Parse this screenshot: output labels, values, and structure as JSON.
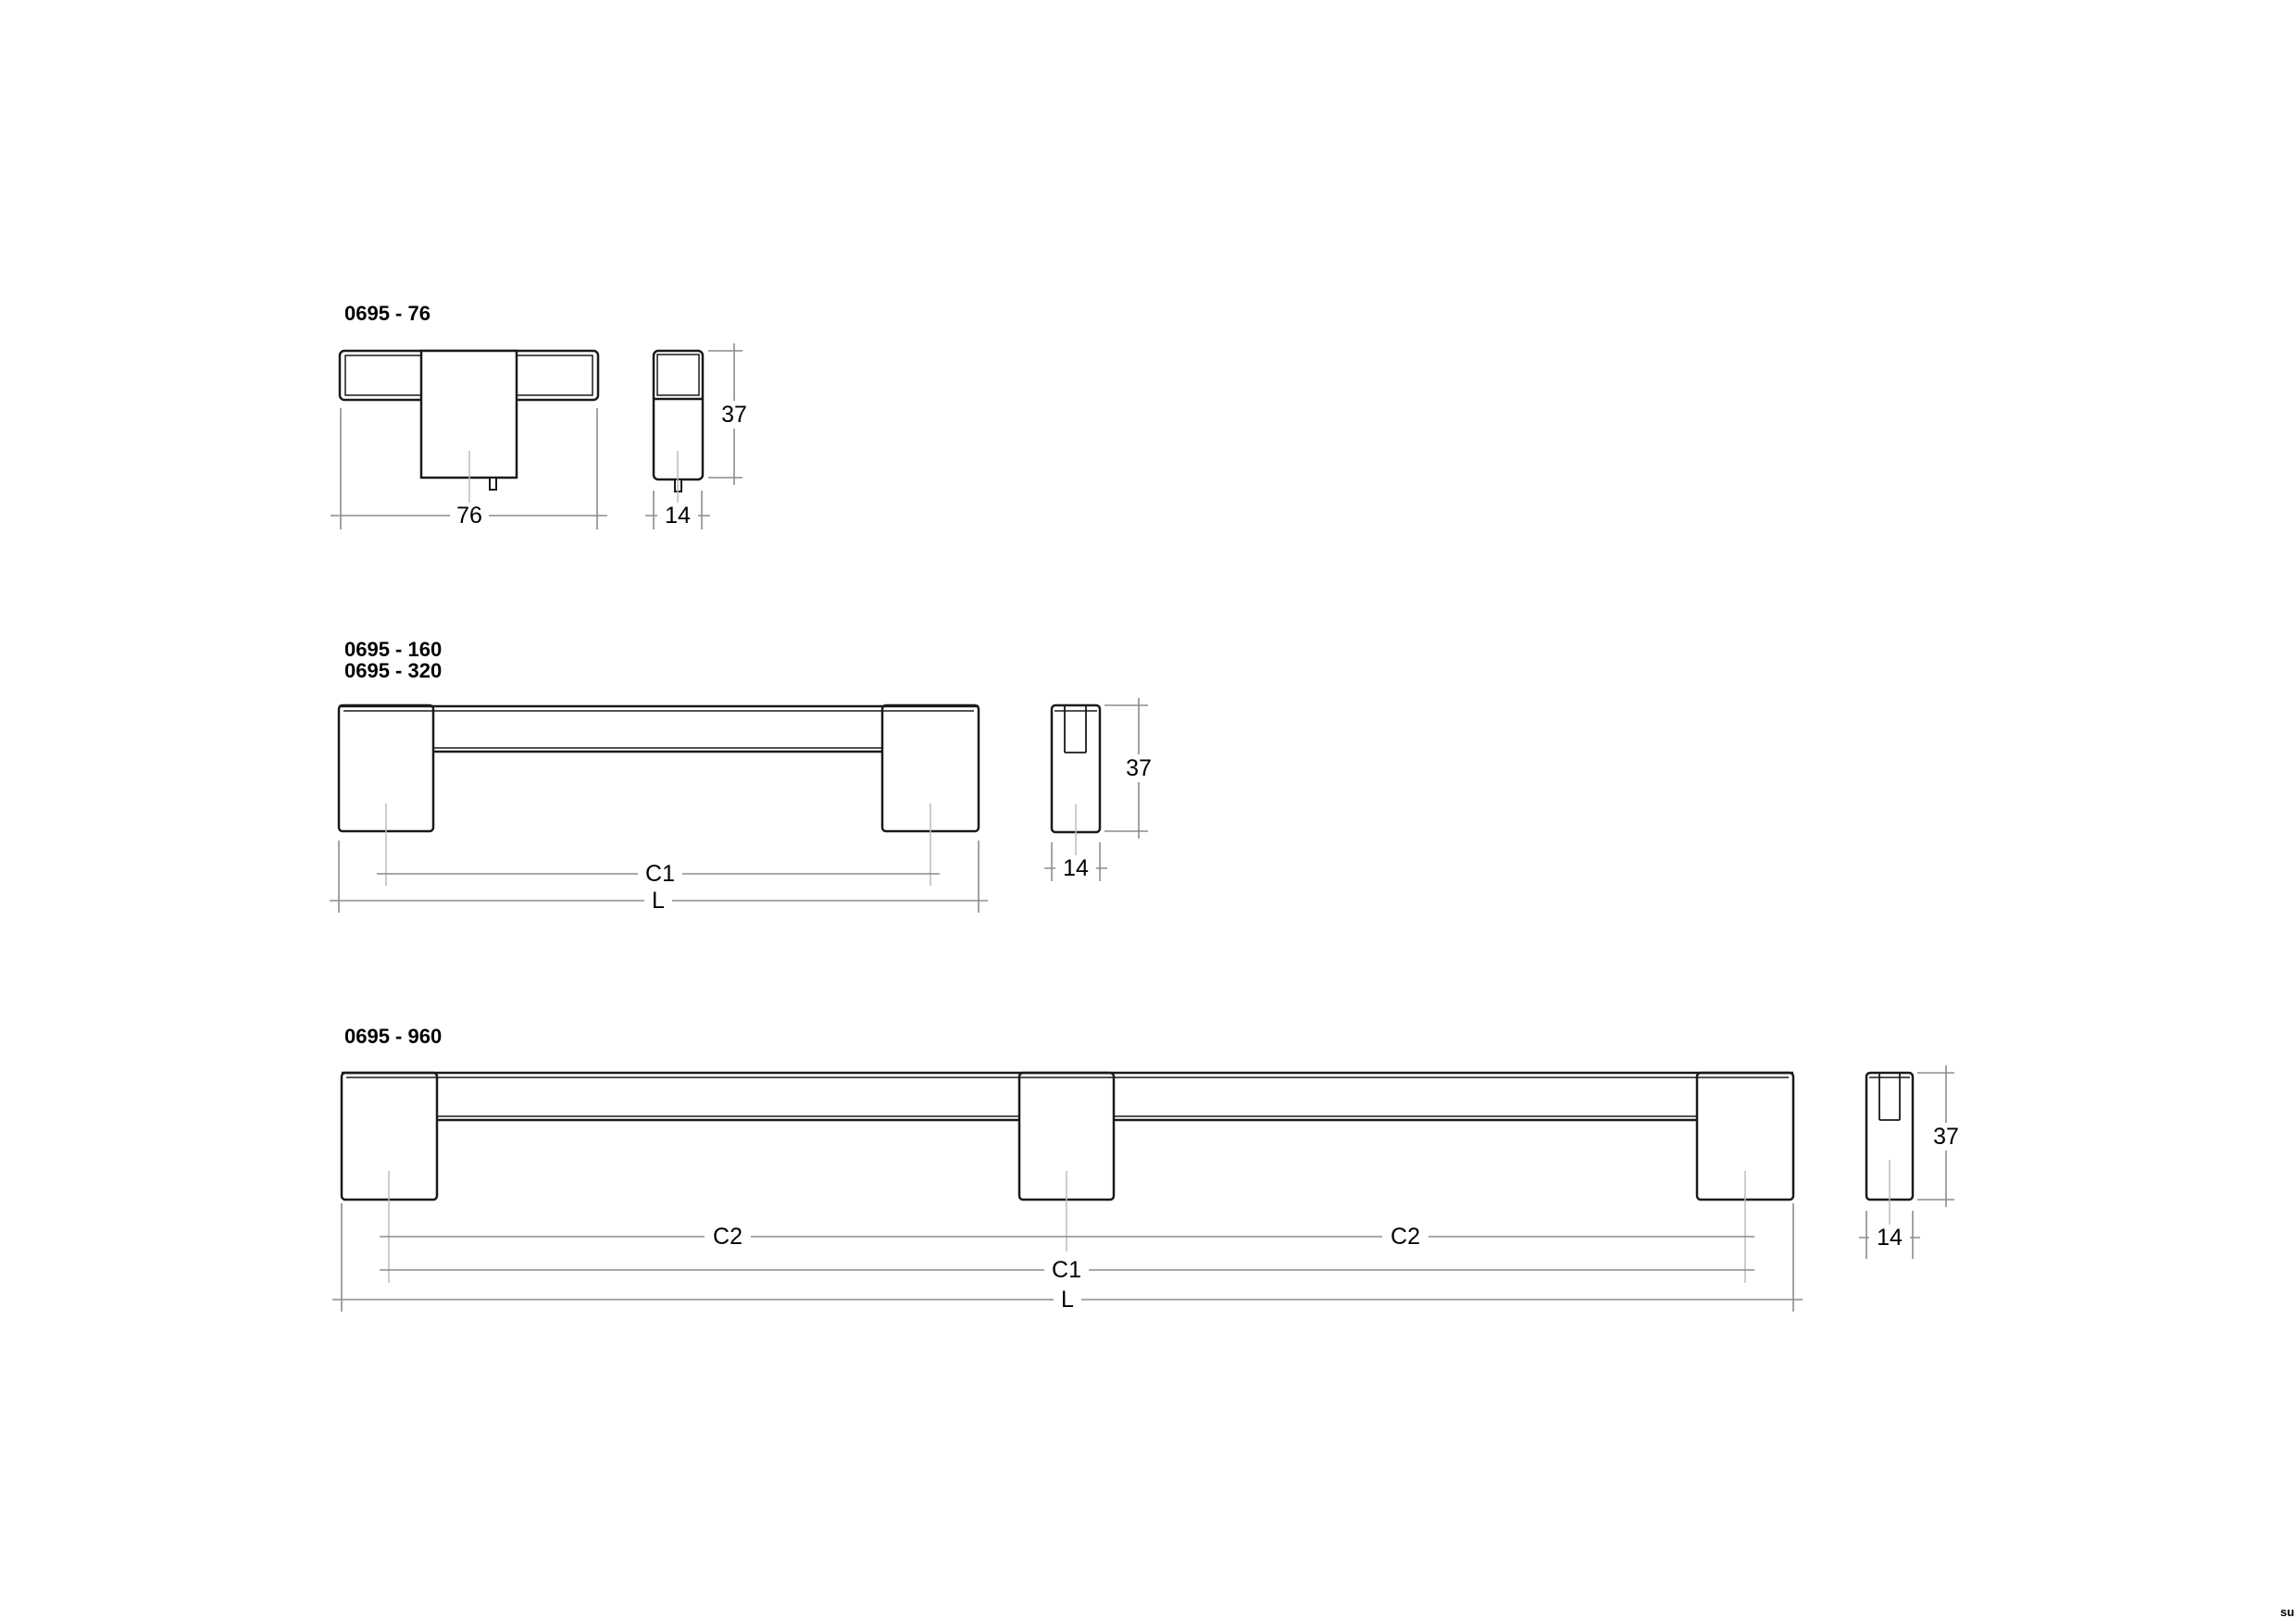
{
  "page": {
    "watermark": "su"
  },
  "colors": {
    "outline": "#1a1a1a",
    "dimension_line": "#8c8c8c",
    "center_line": "#bcbcbc",
    "text": "#000000",
    "background": "#ffffff"
  },
  "drawings": [
    {
      "id": "0695-76",
      "title": "0695 - 76",
      "labels": {
        "width": "76",
        "height": "37",
        "depth": "14"
      }
    },
    {
      "id": "0695-160-320",
      "titles": [
        "0695 - 160",
        "0695 - 320"
      ],
      "labels": {
        "c1": "C1",
        "l": "L",
        "height": "37",
        "depth": "14"
      }
    },
    {
      "id": "0695-960",
      "title": "0695 - 960",
      "labels": {
        "c2": "C2",
        "c1": "C1",
        "l": "L",
        "height": "37",
        "depth": "14"
      }
    }
  ]
}
